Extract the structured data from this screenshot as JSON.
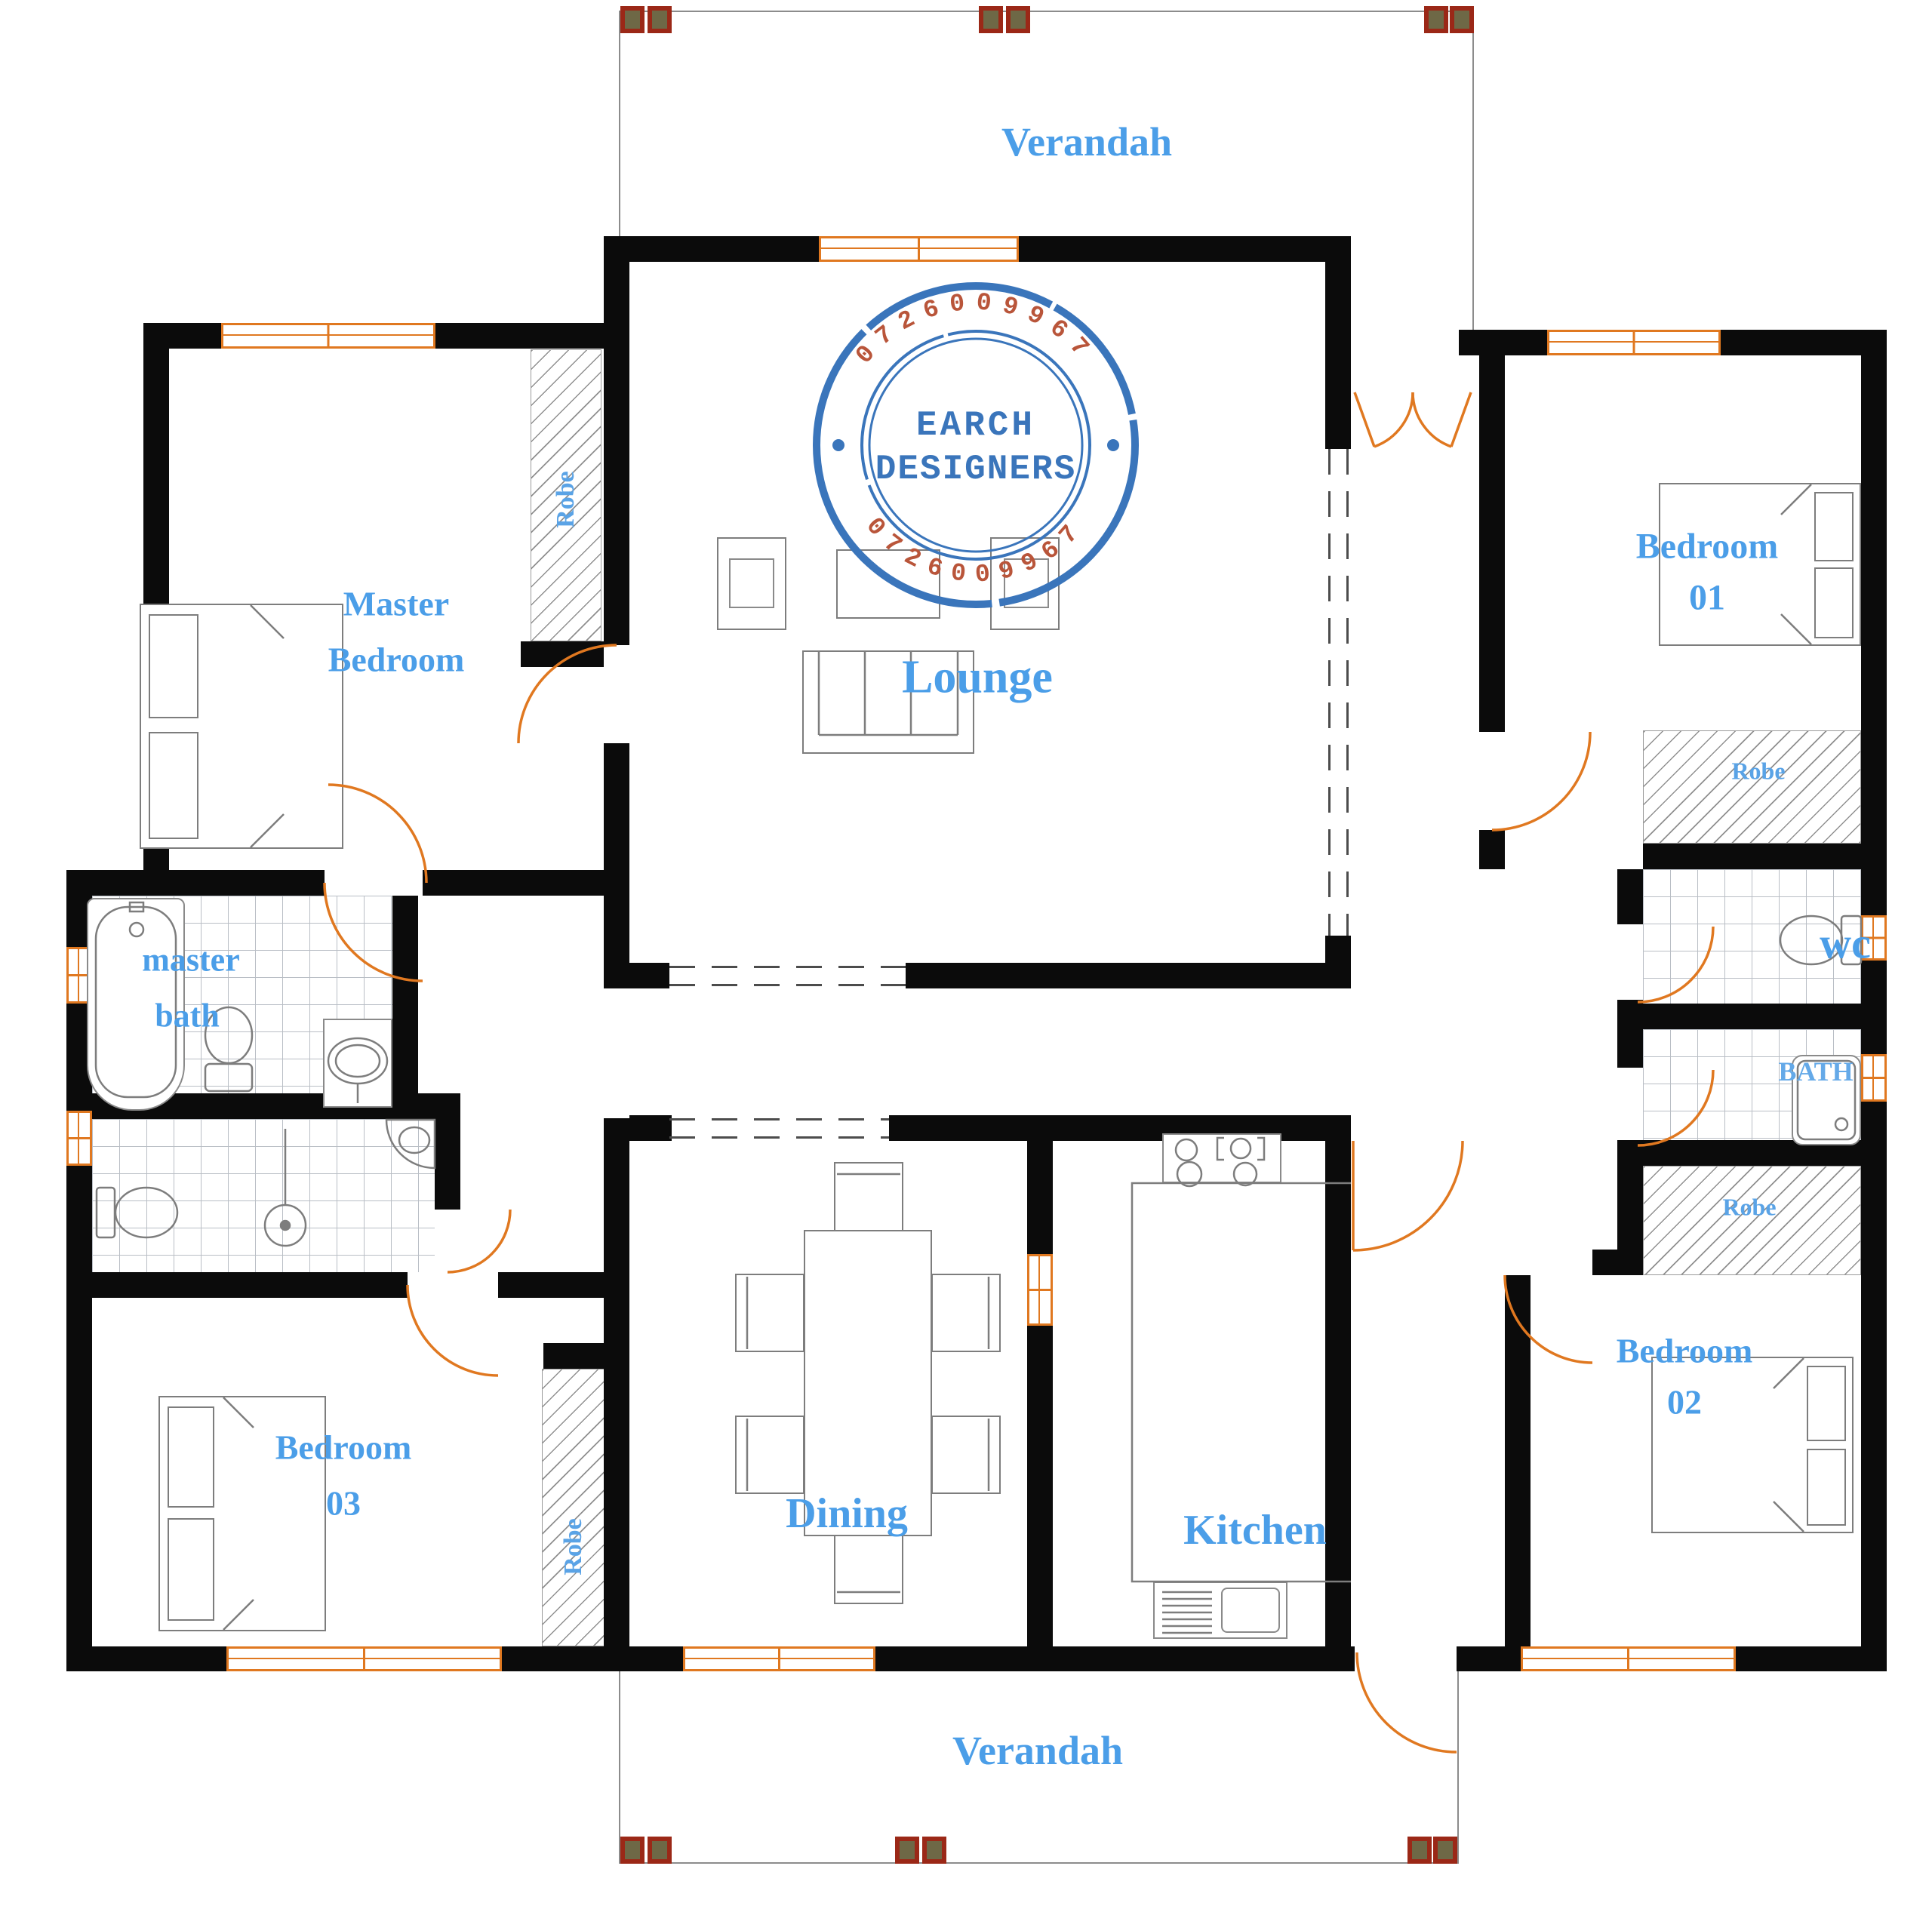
{
  "drawing": {
    "type": "architectural-floor-plan",
    "colors": {
      "wall": "#0b0b0b",
      "opening_orange": "#e07820",
      "label_blue": "#4b9ee8",
      "column_fill": "#6e6846",
      "column_border": "#9b2817",
      "stamp_blue": "#3a75bb",
      "stamp_red": "#b9553a",
      "tile_grid": "#b9bec5",
      "hatch_gray": "#8f8f8f"
    }
  },
  "labels": {
    "verandah_top": "Verandah",
    "verandah_bottom": "Verandah",
    "master_bedroom_line1": "Master",
    "master_bedroom_line2": "Bedroom",
    "lounge": "Lounge",
    "bedroom01_line1": "Bedroom",
    "bedroom01_line2": "01",
    "bedroom02_line1": "Bedroom",
    "bedroom02_line2": "02",
    "bedroom03_line1": "Bedroom",
    "bedroom03_line2": "03",
    "master_bath_line1": "master",
    "master_bath_line2": "bath",
    "wc": "wc",
    "bath": "BATH",
    "dining": "Dining",
    "kitchen": "Kitchen",
    "robe_master": "Robe",
    "robe_bedroom01": "Robe",
    "robe_bedroom02": "Robe",
    "robe_bedroom03": "Robe"
  },
  "stamp": {
    "name_line1": "EARCH",
    "name_line2": "DESIGNERS",
    "phone_top": "0726009967",
    "phone_bottom": "0726009967"
  },
  "icons": {
    "bed": "rectangle with two pillows",
    "bathtub": "rounded tub outline",
    "toilet": "oval bowl with cistern",
    "basin": "oval in counter",
    "shower_tray": "rounded square with drain",
    "stove": "four burner circles",
    "sink": "drainer and bowl",
    "door": "orange quarter-arc swing",
    "window": "orange triple-line glyph",
    "column": "brown square with red border"
  }
}
